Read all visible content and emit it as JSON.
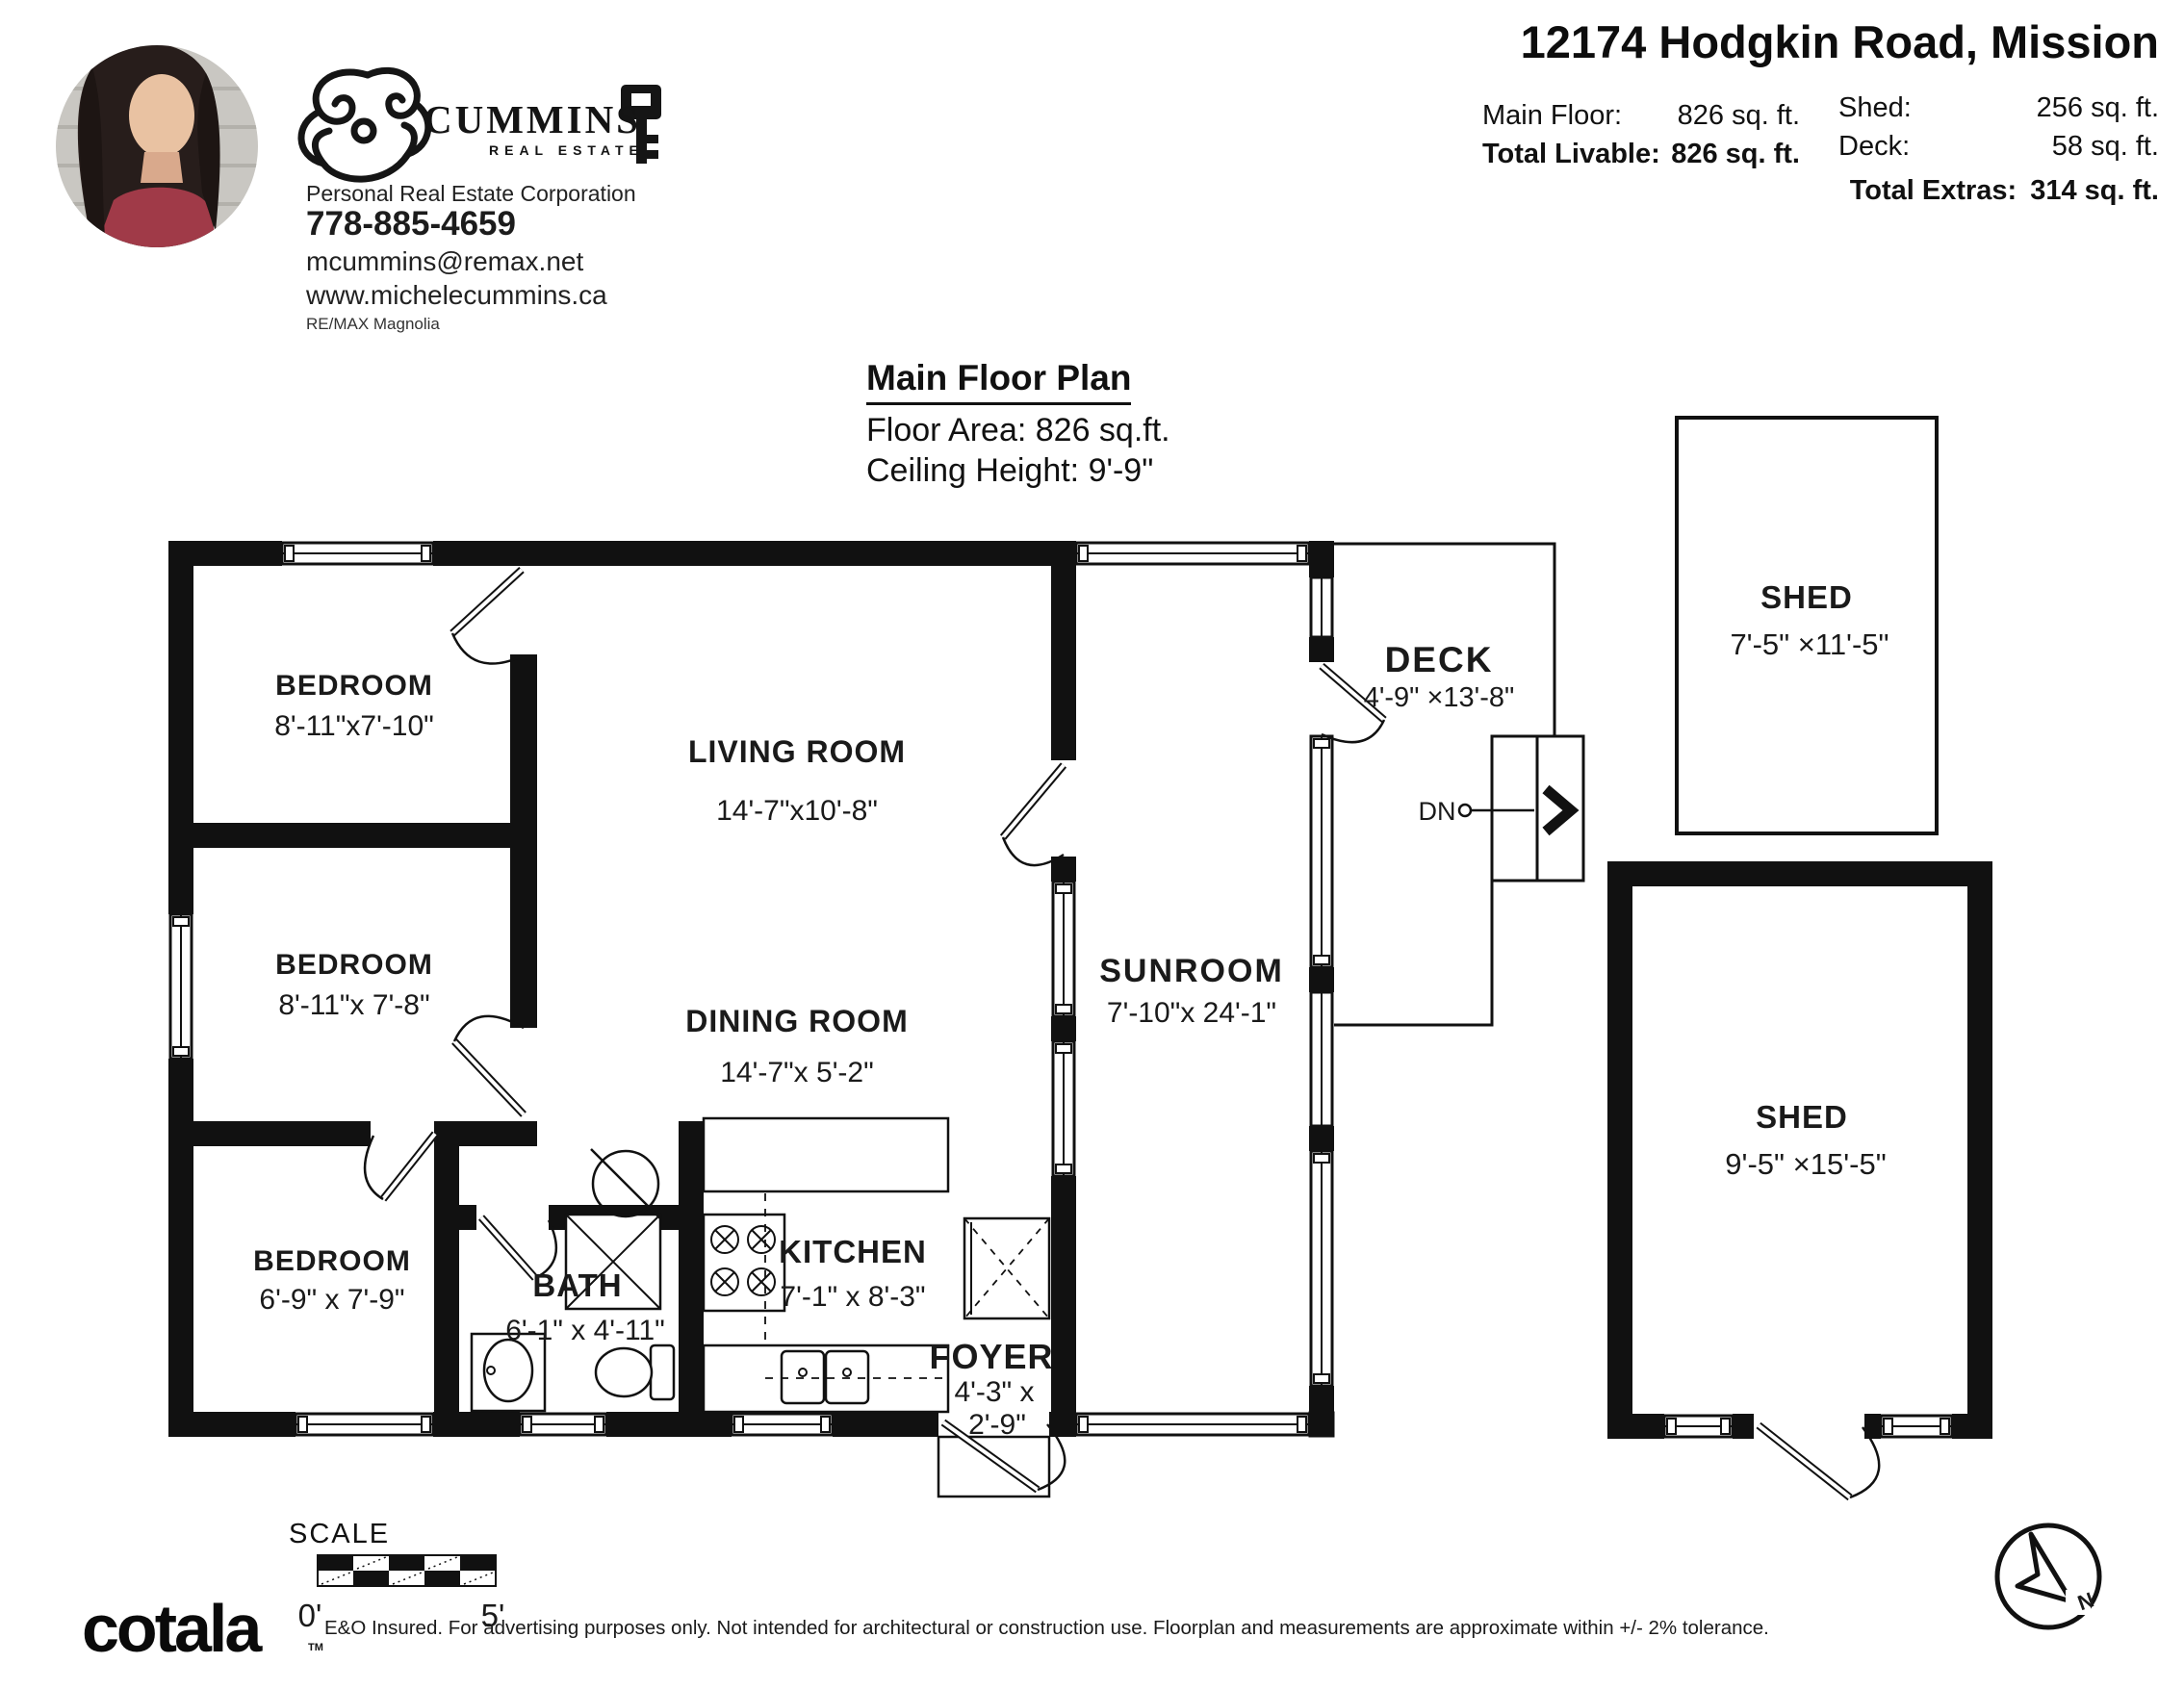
{
  "header": {
    "address": "12174 Hodgkin Road, Mission",
    "stats": [
      {
        "label": "Main Floor:",
        "value": "826 sq. ft."
      },
      {
        "label": "Total Livable:",
        "value": "826 sq. ft."
      },
      {
        "label": "Shed:",
        "value": "256 sq. ft."
      },
      {
        "label": "Deck:",
        "value": "58 sq. ft."
      },
      {
        "label": "Total Extras:",
        "value": "314 sq. ft."
      }
    ]
  },
  "agent": {
    "brand": "CUMMINS",
    "brand_sub": "REAL ESTATE",
    "title": "Personal Real Estate Corporation",
    "phone": "778-885-4659",
    "email": "mcummins@remax.net",
    "website": "www.michelecummins.ca",
    "brokerage": "RE/MAX Magnolia"
  },
  "plan": {
    "title": "Main Floor Plan",
    "floor_area": "Floor Area: 826 sq.ft.",
    "ceiling": "Ceiling Height: 9'-9\""
  },
  "rooms": {
    "bedroom1": {
      "name": "BEDROOM",
      "dims": "8'-11\"x7'-10\""
    },
    "bedroom2": {
      "name": "BEDROOM",
      "dims": "8'-11\"x 7'-8\""
    },
    "bedroom3": {
      "name": "BEDROOM",
      "dims": "6'-9\" x 7'-9\""
    },
    "living": {
      "name": "LIVING ROOM",
      "dims": "14'-7\"x10'-8\""
    },
    "dining": {
      "name": "DINING ROOM",
      "dims": "14'-7\"x 5'-2\""
    },
    "bath": {
      "name": "BATH",
      "dims": "6'-1\" x 4'-11\""
    },
    "kitchen": {
      "name": "KITCHEN",
      "dims": "7'-1\" x 8'-3\""
    },
    "foyer": {
      "name": "FOYER",
      "dims_line1": "4'-3\" x",
      "dims_line2": "2'-9\""
    },
    "sunroom": {
      "name": "SUNROOM",
      "dims": "7'-10\"x 24'-1\""
    },
    "deck": {
      "name": "DECK",
      "dims": "4'-9\" ×13'-8\""
    },
    "shed1": {
      "name": "SHED",
      "dims": "7'-5\" ×11'-5\""
    },
    "shed2": {
      "name": "SHED",
      "dims": "9'-5\" ×15'-5\""
    },
    "stairs_label": "DN"
  },
  "scale": {
    "label": "SCALE",
    "start": "0'",
    "end": "5'"
  },
  "compass": {
    "north": "N"
  },
  "footer": {
    "logo": "cotala",
    "tm": "TM",
    "disclaimer": "E&O Insured. For advertising purposes only. Not intended for architectural or construction use. Floorplan and measurements are approximate within +/- 2% tolerance."
  }
}
